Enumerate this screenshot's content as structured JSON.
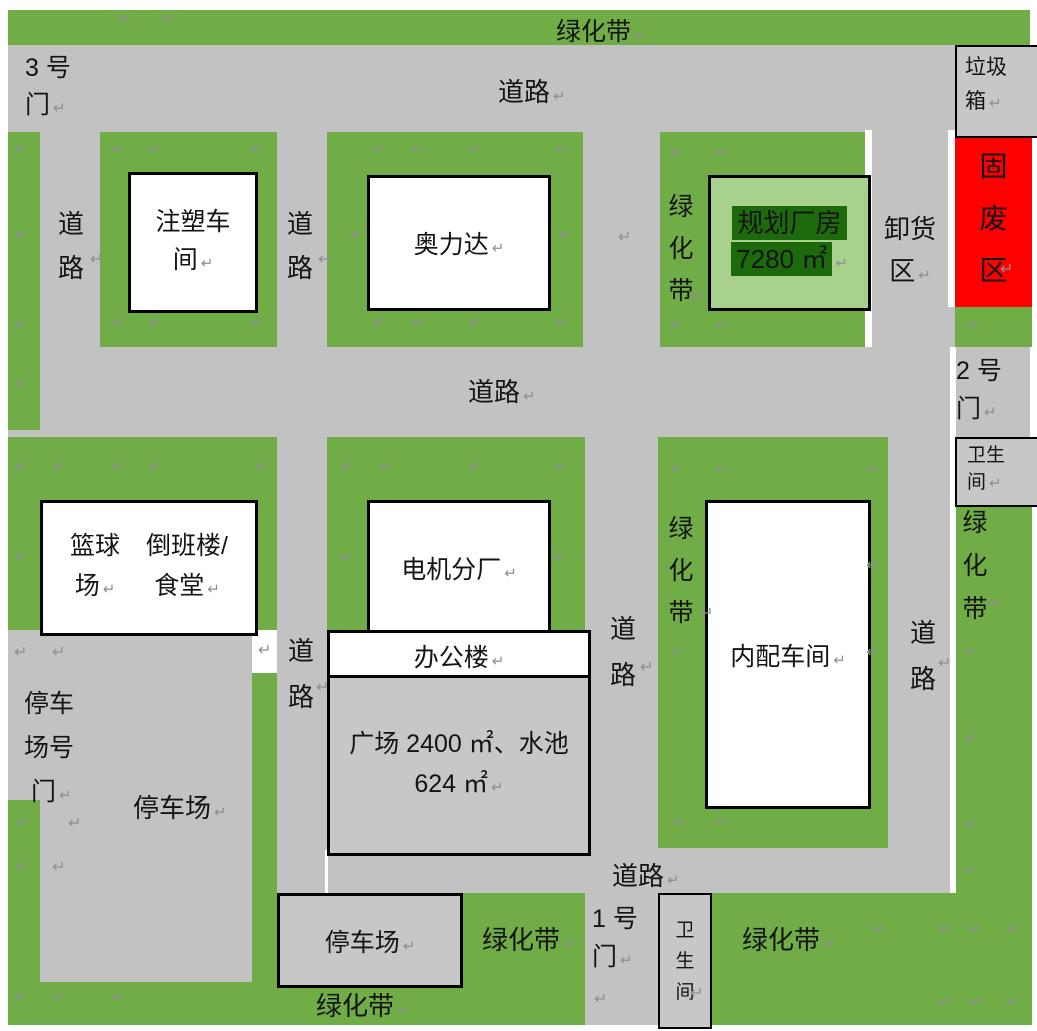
{
  "colors": {
    "green": "#70AD47",
    "light_green": "#A9D18E",
    "dark_green": "#1D6A0D",
    "red": "#FF0000",
    "road": "#C2C2C2",
    "box_gray": "#C7C7C7",
    "mark": "#8F8F8F"
  },
  "icons": {
    "pilcrow": "↵"
  },
  "labels": {
    "green_belt": "绿化带",
    "road": "道路",
    "gate3": [
      "3 号",
      "门"
    ],
    "gate2": [
      "2 号",
      "门"
    ],
    "gate1": [
      "1 号",
      "门"
    ],
    "trash_bin": [
      "垃圾",
      "箱"
    ],
    "solid_waste": "固废区",
    "unloading": [
      "卸货",
      "区"
    ],
    "injection_workshop": [
      "注塑车",
      "间"
    ],
    "aolida": "奥力达",
    "planned_factory": [
      "规划厂房",
      "7280 ㎡"
    ],
    "basketball": [
      "篮球",
      "场"
    ],
    "shift_canteen": [
      "倒班楼/",
      "食堂"
    ],
    "motor_factory": "电机分厂",
    "office_building": "办公楼",
    "plaza": [
      "广场 2400 ㎡、水池",
      "624 ㎡"
    ],
    "inner_workshop": "内配车间",
    "restroom": [
      "卫生",
      "间"
    ],
    "restroom_vertical": "卫生间",
    "parking": "停车场",
    "parking_gate": [
      "停车",
      "场号",
      "门"
    ]
  }
}
